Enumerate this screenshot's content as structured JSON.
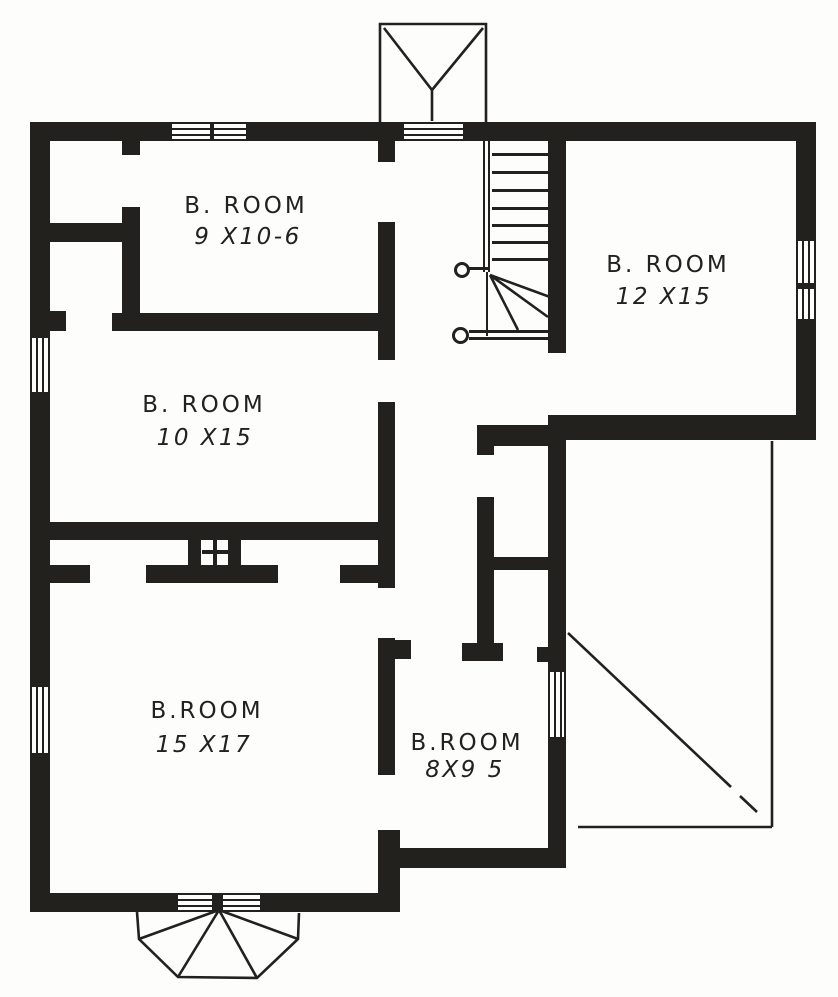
{
  "colors": {
    "ink": "#22211d",
    "paper": "#fdfdfb"
  },
  "rooms": [
    {
      "id": "bedroom-top-left",
      "name": "B. ROOM",
      "size": "9 X10-6"
    },
    {
      "id": "bedroom-top-right",
      "name": "B. ROOM",
      "size": "12 X15"
    },
    {
      "id": "bedroom-mid-left",
      "name": "B. ROOM",
      "size": "10 X15"
    },
    {
      "id": "bedroom-bottom-left",
      "name": "B.ROOM",
      "size": "15 X17"
    },
    {
      "id": "bedroom-bottom-mid",
      "name": "B.ROOM",
      "size": "8X9 5"
    }
  ],
  "features": {
    "staircase": "winder-staircase",
    "chimney": "chimney-flue-cross",
    "bay_window": "bay-window",
    "gable": "roof-gable",
    "open_area": "open-roof-area-diagonal"
  }
}
